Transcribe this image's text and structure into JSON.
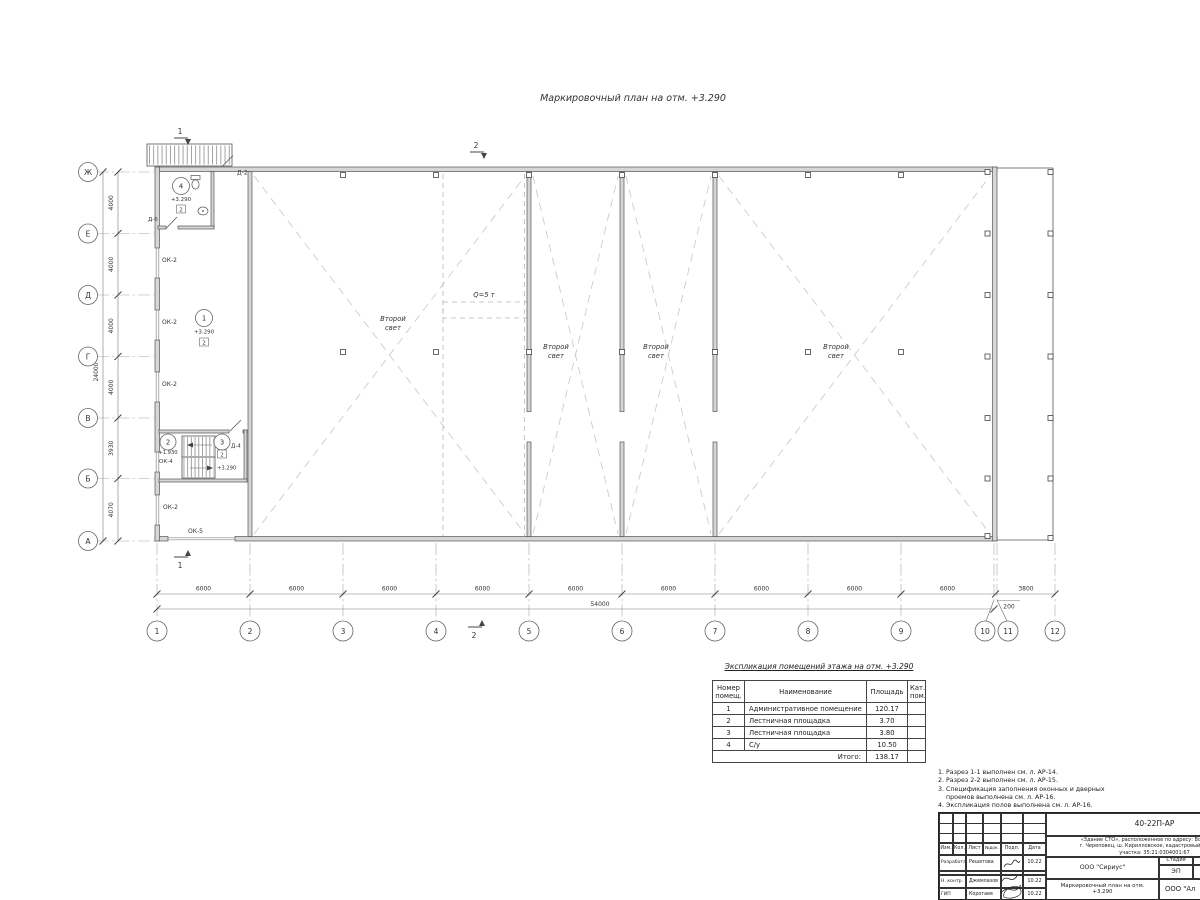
{
  "plan": {
    "title": "Маркировочный план на отм. +3.290",
    "second_light_line1": "Второй",
    "second_light_line2": "свет",
    "crane_label": "Q=5 т",
    "axis_rows": [
      "Ж",
      "Е",
      "Д",
      "Г",
      "В",
      "Б",
      "А"
    ],
    "axis_cols": [
      "1",
      "2",
      "3",
      "4",
      "5",
      "6",
      "7",
      "8",
      "9",
      "10",
      "11",
      "12"
    ],
    "dims_left": [
      "4000",
      "4000",
      "4000",
      "4000",
      "3930",
      "4070"
    ],
    "dims_left_total": "24000",
    "dims_bottom": [
      "6000",
      "6000",
      "6000",
      "6000",
      "6000",
      "6000",
      "6000",
      "6000",
      "6000"
    ],
    "dims_bottom_total": "54000",
    "dim_gap": "200",
    "dim_right": "3800",
    "sections": {
      "one": "1",
      "two": "2"
    },
    "tags": {
      "room1": {
        "num": "1",
        "elev": "+3.290",
        "cat": "2"
      },
      "room2": {
        "num": "2",
        "elev": "+1.930"
      },
      "room3": {
        "num": "3",
        "elev": "+3.290",
        "cat": "2"
      },
      "room4": {
        "num": "4",
        "elev": "+3.290",
        "cat": "2"
      }
    },
    "openings": {
      "d2": "Д-2",
      "d4": "Д-4",
      "d6": "Д-6",
      "ok2": "ОК-2",
      "ok4": "ОК-4",
      "ok5": "ОК-5"
    }
  },
  "explication": {
    "title": "Экспликация помещений этажа на отм. +3.290",
    "headers": {
      "num": "Номер\nпомещ.",
      "name": "Наименование",
      "area": "Площадь",
      "cat": "Кат.\nпом."
    },
    "rows": [
      {
        "num": "1",
        "name": "Административное помещение",
        "area": "120.17"
      },
      {
        "num": "2",
        "name": "Лестничная площадка",
        "area": "3.70"
      },
      {
        "num": "3",
        "name": "Лестничная площадка",
        "area": "3.80"
      },
      {
        "num": "4",
        "name": "С/у",
        "area": "10.50"
      }
    ],
    "total_label": "Итого:",
    "total_value": "138.17"
  },
  "notes": {
    "lines": [
      "1. Разрез 1-1 выполнен см. л. АР-14.",
      "2. Разрез 2-2 выполнен см. л. АР-15.",
      "3. Спецификация заполнения оконных и дверных",
      "    проемов выполнена см. л. АР-16.",
      "4. Экспликация полов выполнена см. л. АР-16."
    ]
  },
  "titleblock": {
    "doc_number": "40-22П-АР",
    "address_line1": "«Здание СТО», расположенное по адресу: Вологодская",
    "address_line2": "г. Череповец, ш. Кирилловское, кадастровый номер зем",
    "address_line3": "участка: 35:21:0304001:67",
    "cols": {
      "izm": "Изм.",
      "kol": "Кол.",
      "list": "Лист",
      "ndoc": "№док.",
      "podp": "Подп.",
      "date": "Дата"
    },
    "rows": [
      {
        "role": "Разработал",
        "name": "Решетова",
        "date": "10.22"
      },
      {
        "role": "Н. контр.",
        "name": "Джемлазов",
        "date": "10.22"
      },
      {
        "role": "ГИП",
        "name": "Коротаев",
        "date": "10.22"
      }
    ],
    "org": "ООО \"Сириус\"",
    "stage_label": "Стадия",
    "sheet_label": "Лист",
    "stage": "ЭП",
    "sheet": "12",
    "sheet_title": "Маркировочный план на отм. +3.290",
    "org2": "ООО \"Ал"
  }
}
